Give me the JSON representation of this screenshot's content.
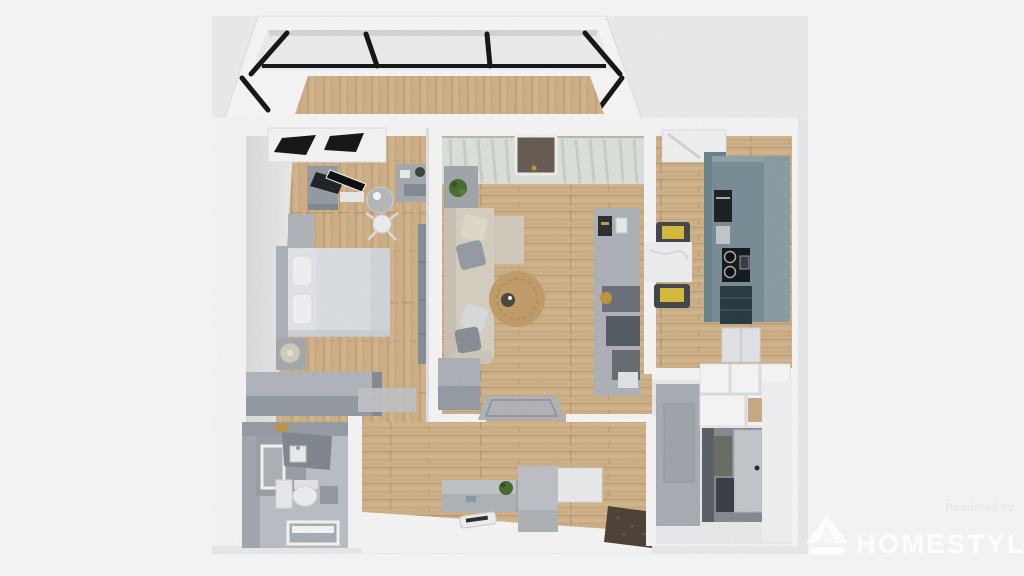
{
  "watermark": {
    "brand": "HOMESTYLER",
    "tagline": "Rendered by",
    "logo_icon": "homestyler-house-logo"
  },
  "scene": {
    "kind": "3d-floorplan-top-down-render",
    "rooms": [
      {
        "name": "balcony",
        "features": [
          "glass walls with black frames",
          "wood floor"
        ]
      },
      {
        "name": "bedroom",
        "features": [
          "double bed",
          "nightstand with lamp",
          "foot-of-bed dresser",
          "desk with monitor",
          "office chair",
          "round side table",
          "shelf",
          "tall wardrobe",
          "window"
        ]
      },
      {
        "name": "living-room",
        "features": [
          "l-shaped beige sofa with pillows",
          "round jute rug",
          "sideboard with plant",
          "media wall unit",
          "sheer curtains",
          "balcony door",
          "entry rug"
        ]
      },
      {
        "name": "kitchen",
        "features": [
          "teal cabinet run",
          "oven",
          "cooktop with pots",
          "marble dining table",
          "two chairs with yellow seats",
          "window"
        ]
      },
      {
        "name": "bathroom",
        "features": [
          "shower",
          "vanity with sink",
          "toilet",
          "storage",
          "door"
        ]
      },
      {
        "name": "hallway",
        "features": [
          "bench with plant",
          "shoe cabinets",
          "doormat",
          "floor remote"
        ]
      },
      {
        "name": "entry-closet",
        "features": [
          "built-in white shelving with wood cubbies",
          "gray wardrobe panel",
          "interior door",
          "tiled floor"
        ]
      }
    ]
  },
  "colors": {
    "background": "#f1f2f4",
    "wall": "#fcfcfd",
    "wall_shadow": "#e7e8ea",
    "wood": "#d4b58c",
    "wood_dark": "#c3a176",
    "frame_black": "#17191c",
    "curtain": "#e3e7e1",
    "sofa": "#ddd6c7",
    "pillow_gray": "#9aa1a9",
    "rug_round": "#c8a26e",
    "rug_entry": "#b8b9bd",
    "kitchen_cabinet": "#7d939b",
    "kitchen_counter": "#93a9ad",
    "appliance_dark": "#20242a",
    "chair_yellow": "#ddc13d",
    "marble": "#f4f5f6",
    "furniture_gray": "#aeb3ba",
    "furniture_gray_dark": "#8f959d",
    "bed_linen": "#e9ebee",
    "bathroom_wall": "#9ca2a9",
    "bathroom_floor": "#c0c5cb",
    "plant": "#4d7134",
    "doormat": "#51463a",
    "gold": "#c79b3e",
    "watermark_text": "#ffffff",
    "tagline_text": "#dfe1e6"
  }
}
